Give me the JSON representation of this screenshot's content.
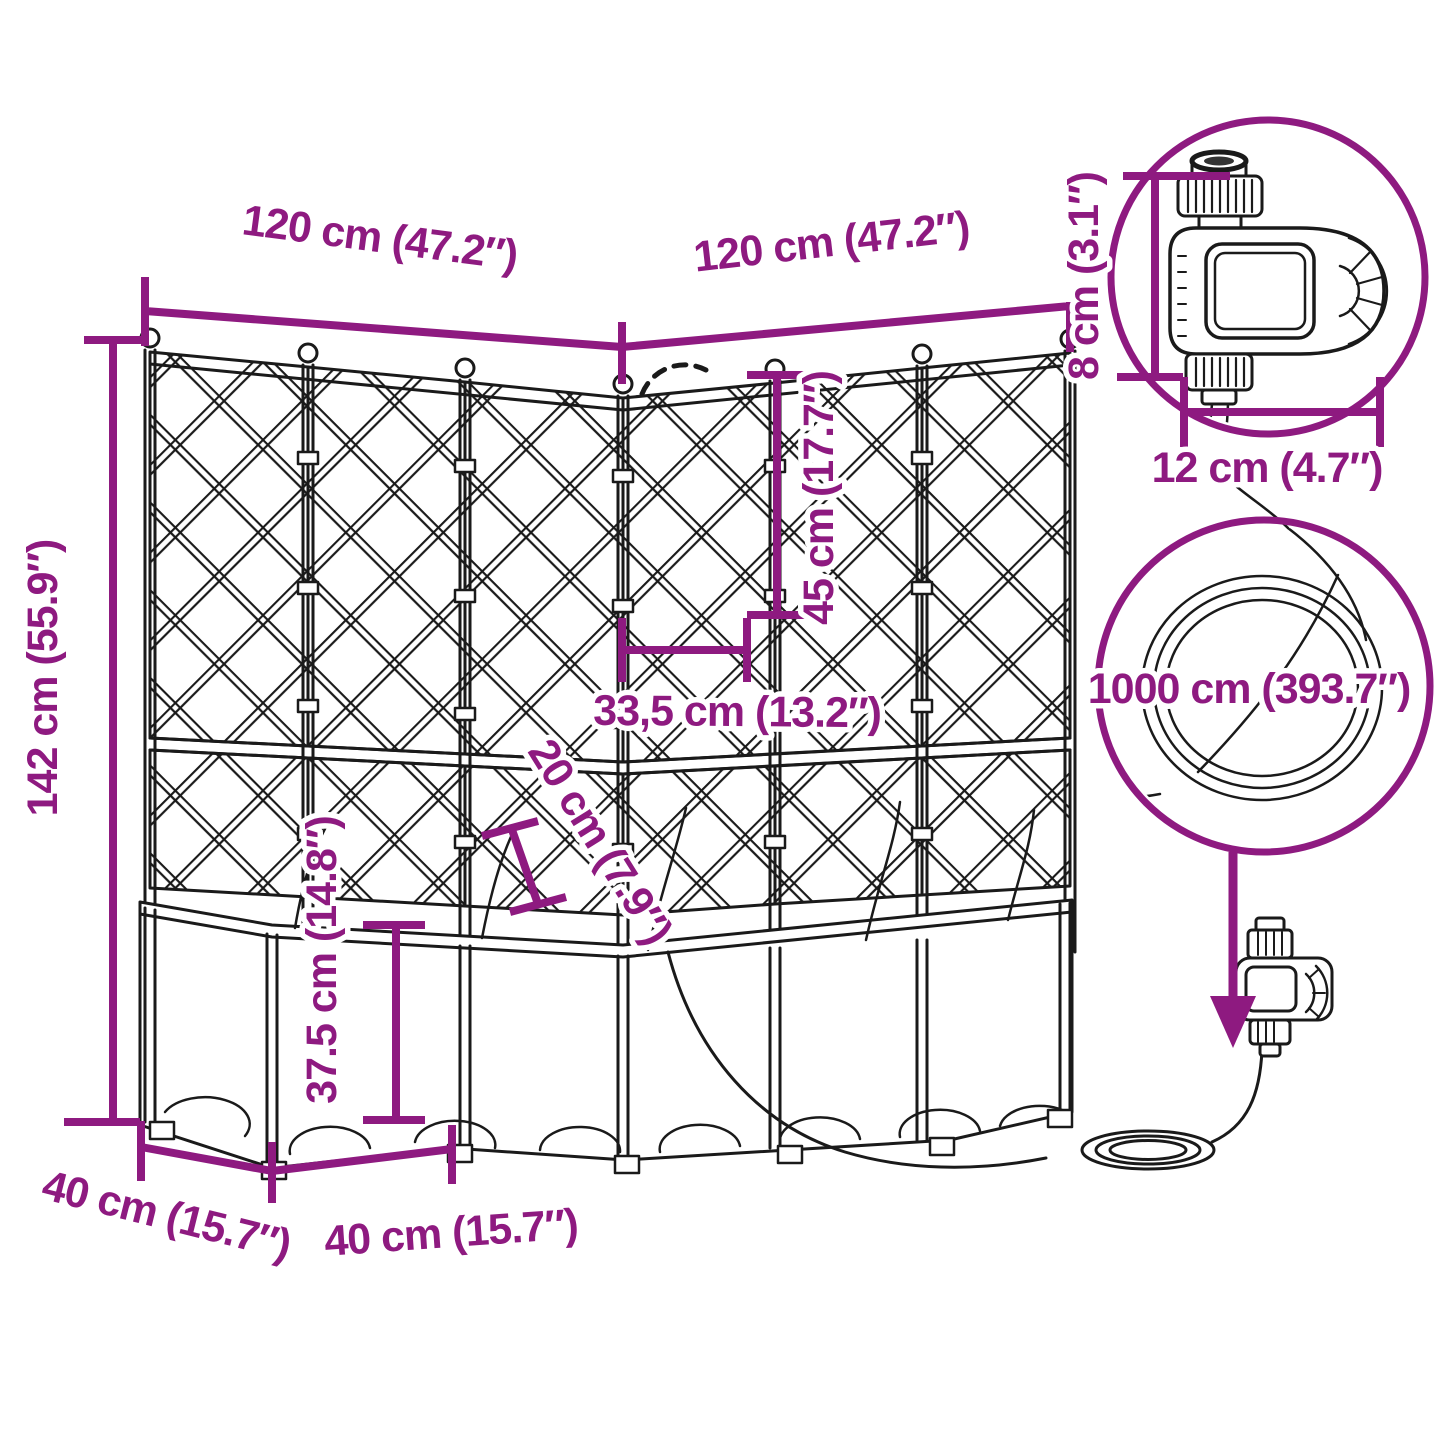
{
  "diagram": {
    "accent_color": "#8e1a80",
    "line_color": "#1a1a1a",
    "dimensions": {
      "top_width_left": "120 cm (47.2″)",
      "top_width_right": "120 cm (47.2″)",
      "total_height": "142 cm (55.9″)",
      "trellis_upper_height": "45 cm (17.7″)",
      "segment_width": "33,5 cm (13.2″)",
      "clearance_height": "20 cm (7.9″)",
      "planter_box_height": "37.5 cm (14.8″)",
      "depth_side_left": "40 cm (15.7″)",
      "depth_side_front": "40 cm (15.7″)",
      "timer_height": "8 cm (3.1″)",
      "timer_width": "12 cm (4.7″)",
      "hose_length": "1000 cm (393.7″)"
    }
  }
}
